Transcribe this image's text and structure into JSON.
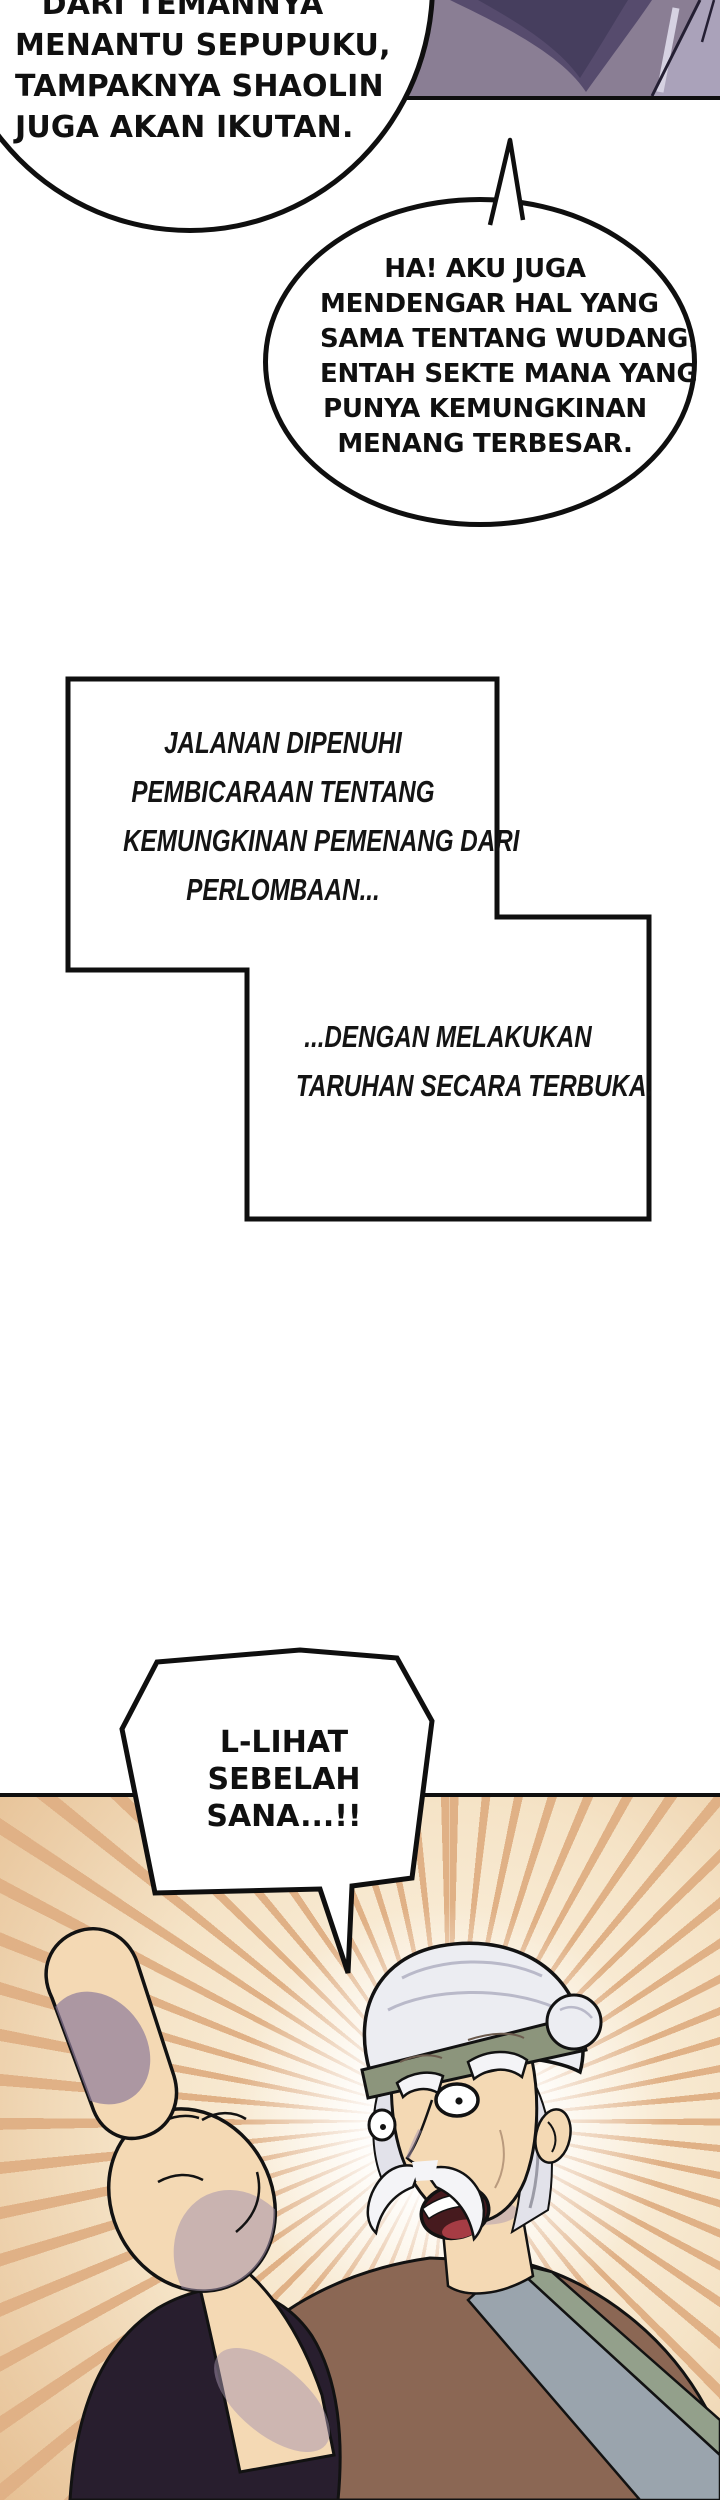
{
  "bubbles": {
    "bubble1": {
      "lines": [
        "DARI TEMANNYA",
        "MENANTU SEPUPUKU,",
        "TAMPAKNYA SHAOLIN",
        "JUGA AKAN IKUTAN."
      ]
    },
    "bubble2": {
      "lines": [
        "HA! AKU JUGA",
        "MENDENGAR HAL YANG",
        "SAMA TENTANG WUDANG.",
        "ENTAH SEKTE MANA YANG",
        "PUNYA KEMUNGKINAN",
        "MENANG TERBESAR."
      ]
    },
    "bubble3": {
      "lines": [
        "L-LIHAT",
        "SEBELAH",
        "SANA...!!"
      ]
    }
  },
  "captions": {
    "caption1": {
      "lines": [
        "JALANAN DIPENUHI",
        "PEMBICARAAN TENTANG",
        "KEMUNGKINAN PEMENANG DARI",
        "PERLOMBAAN..."
      ]
    },
    "caption2": {
      "lines": [
        "...DENGAN MELAKUKAN",
        "TARUHAN SECARA TERBUKA."
      ]
    }
  },
  "colors": {
    "ink": "#0f0f0f",
    "paper": "#ffffff",
    "top_panel_bg": "#8a7e94",
    "top_panel_shadow": "#564b6d",
    "top_panel_shadow_dark": "#463e5e",
    "top_panel_highlight": "#aaa2ba",
    "ray": "#e0b186",
    "ray_background": "#f5e3c6",
    "skin": "#f4d9b4",
    "skin_shadow": "#a593ad",
    "skin_shadow_deep": "#8d7b9a",
    "head_wrap": "#ecedf2",
    "wrap_band": "#8c957c",
    "hair": "#e2e2ea",
    "robe": "#8b6754",
    "robe_shadow": "#6e4f40",
    "sleeve": "#281e2e",
    "collar_grey": "#9aa4ad",
    "collar_green": "#93a08b",
    "mouth": "#461a1e",
    "tongue": "#a63c44",
    "facial_hair": "#f4f4f7"
  }
}
